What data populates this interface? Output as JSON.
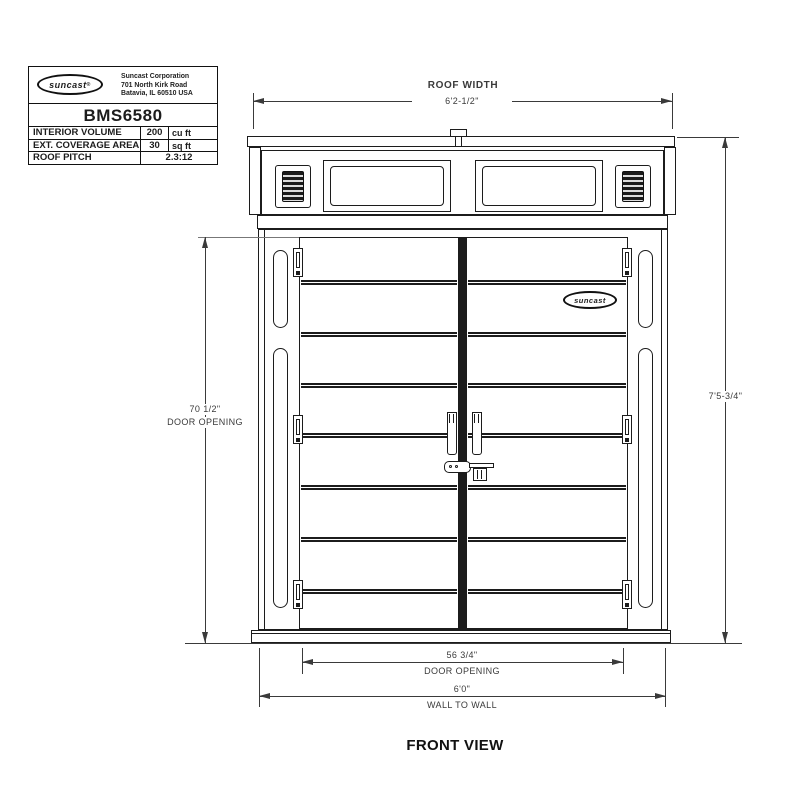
{
  "title_block": {
    "logo": "suncast",
    "reg_mark": "®",
    "company_lines": [
      "Suncast Corporation",
      "701 North Kirk Road",
      "Batavia, IL 60510 USA"
    ],
    "model": "BMS6580",
    "specs": [
      {
        "label": "INTERIOR VOLUME",
        "value": "200",
        "unit": "cu ft"
      },
      {
        "label": "EXT. COVERAGE AREA",
        "value": "30",
        "unit": "sq ft"
      },
      {
        "label": "ROOF PITCH",
        "value": "2.3:12",
        "unit": ""
      }
    ]
  },
  "dims": {
    "roof_width": {
      "label": "ROOF WIDTH",
      "value": "6'2-1/2\""
    },
    "door_height": {
      "value": "70 1/2\"",
      "label": "DOOR OPENING"
    },
    "overall_height": {
      "value": "7'5-3/4\""
    },
    "door_width": {
      "value": "56 3/4\"",
      "label": "DOOR OPENING"
    },
    "wall_width": {
      "value": "6'0\"",
      "label": "WALL TO WALL"
    }
  },
  "door_badge": "suncast",
  "view_label": "FRONT VIEW",
  "colors": {
    "line": "#1c1c1c",
    "dim_line": "#3a3a3a",
    "background": "#ffffff"
  }
}
